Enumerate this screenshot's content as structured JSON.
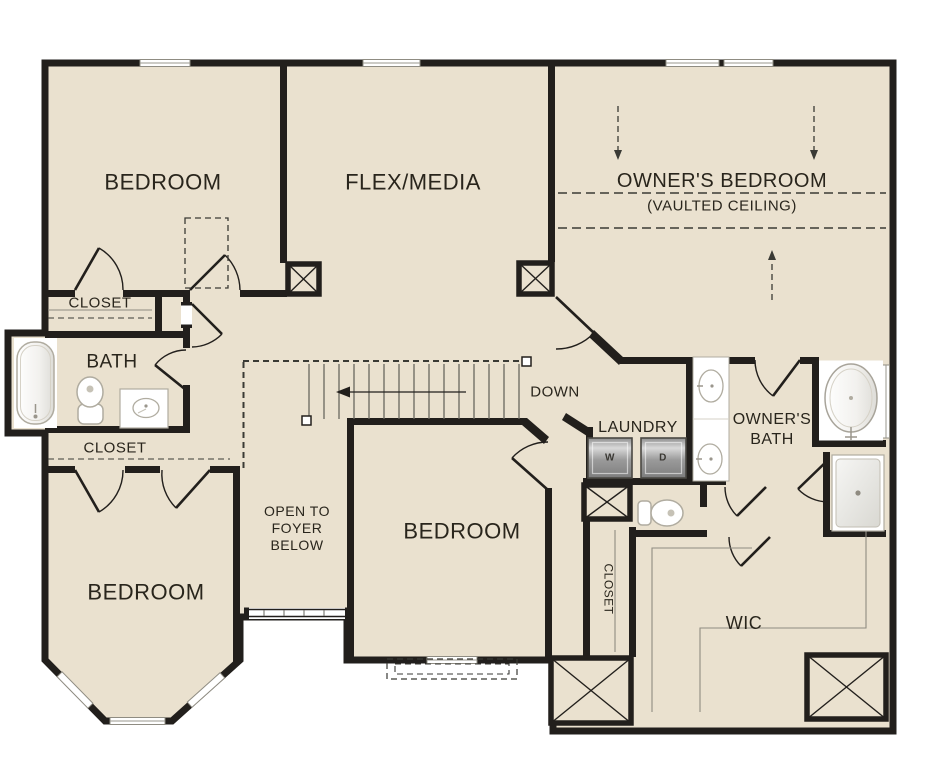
{
  "colors": {
    "floor": "#eae1cf",
    "wall": "#221f1c",
    "fixture_outline": "#b0aca0",
    "background": "#ffffff"
  },
  "rooms": {
    "bedroom_top_left": {
      "label": "BEDROOM"
    },
    "flex_media": {
      "label": "FLEX/MEDIA"
    },
    "owners_bedroom": {
      "label": "OWNER'S BEDROOM",
      "sublabel": "(VAULTED CEILING)"
    },
    "closet_upper": {
      "label": "CLOSET"
    },
    "hall_bath": {
      "label": "BATH"
    },
    "closet_lower": {
      "label": "CLOSET"
    },
    "bedroom_bottom_left": {
      "label": "BEDROOM"
    },
    "open_to_foyer": {
      "lines": [
        "OPEN TO",
        "FOYER",
        "BELOW"
      ]
    },
    "bedroom_center": {
      "label": "BEDROOM"
    },
    "stairs": {
      "label": "DOWN"
    },
    "laundry": {
      "label": "LAUNDRY",
      "washer": "W",
      "dryer": "D"
    },
    "owners_bath": {
      "lines": [
        "OWNER'S",
        "BATH"
      ]
    },
    "closet_corridor": {
      "label": "CLOSET"
    },
    "wic": {
      "label": "WIC"
    }
  }
}
